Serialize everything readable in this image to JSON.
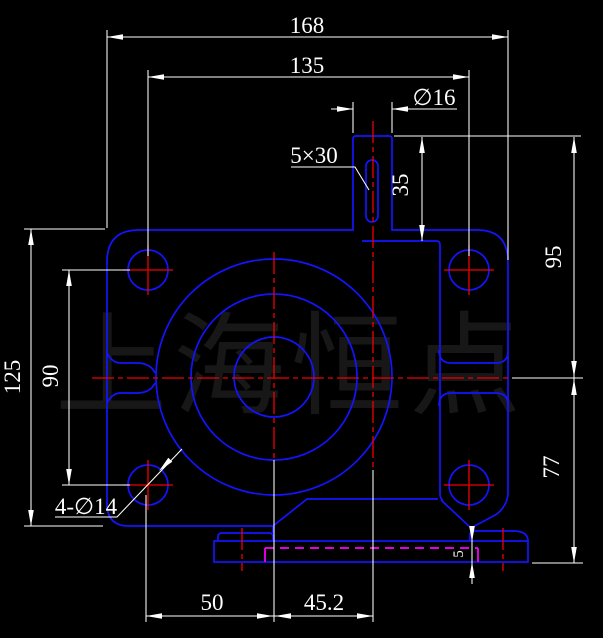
{
  "watermark": "上海恒点",
  "colors": {
    "background": "#000000",
    "geometry": "#1414ff",
    "centerline": "#f00000",
    "hidden_line": "#ff00ff",
    "dimension": "#ffffff",
    "watermark": "#171717"
  },
  "dims": {
    "overall_width": "168",
    "hole_spacing_h": "135",
    "boss_dia": "∅16",
    "slot": "5×30",
    "boss_height": "35",
    "upper_height": "95",
    "overall_height": "125",
    "hole_spacing_v": "90",
    "lower_height": "77",
    "corner_holes": "4-∅14",
    "offset_left": "50",
    "offset_right": "45.2",
    "base_step": "5"
  }
}
